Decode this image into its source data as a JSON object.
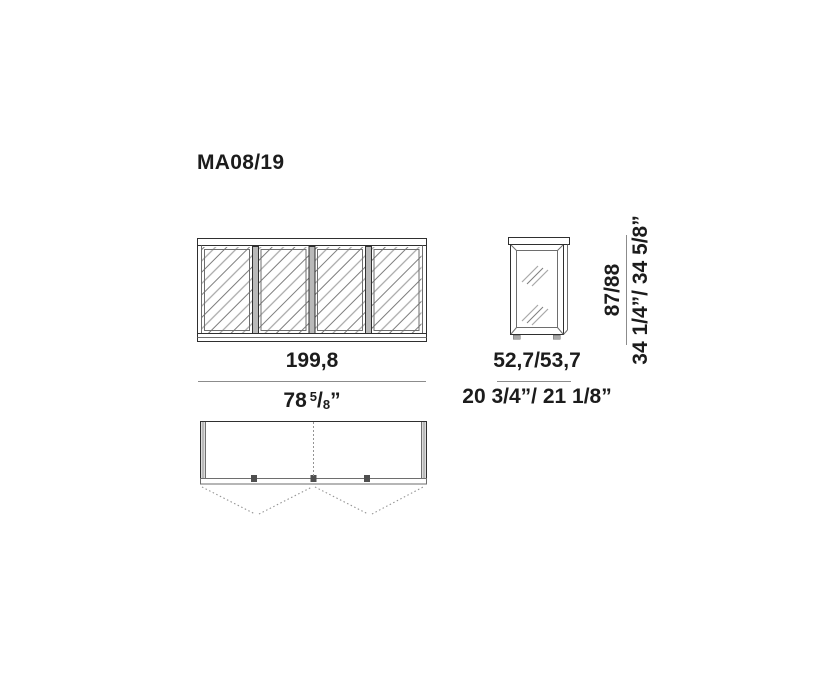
{
  "title": "MA08/19",
  "dimensions": {
    "front_width": {
      "cm": "199,8",
      "inch_whole": "78",
      "inch_numerator": "5",
      "inch_denominator": "8",
      "inch_unit": "”"
    },
    "depth": {
      "cm": "52,7/53,7",
      "inch": "20 3/4”/ 21 1/8”"
    },
    "height": {
      "cm": "87/88",
      "inch": "34 1/4”/ 34 5/8”"
    }
  },
  "colors": {
    "background": "#ffffff",
    "line": "#2f2f2f",
    "line_light": "#6e6e6e",
    "hatch_light": "#a8a8a8",
    "hatch_dark": "#7d7d7d",
    "panel_gray": "#b9b9b9",
    "hinge_dark": "#4f4f4f",
    "dim_line": "#8c8c8c",
    "dash": "#949494",
    "text": "#1c1c1c"
  }
}
